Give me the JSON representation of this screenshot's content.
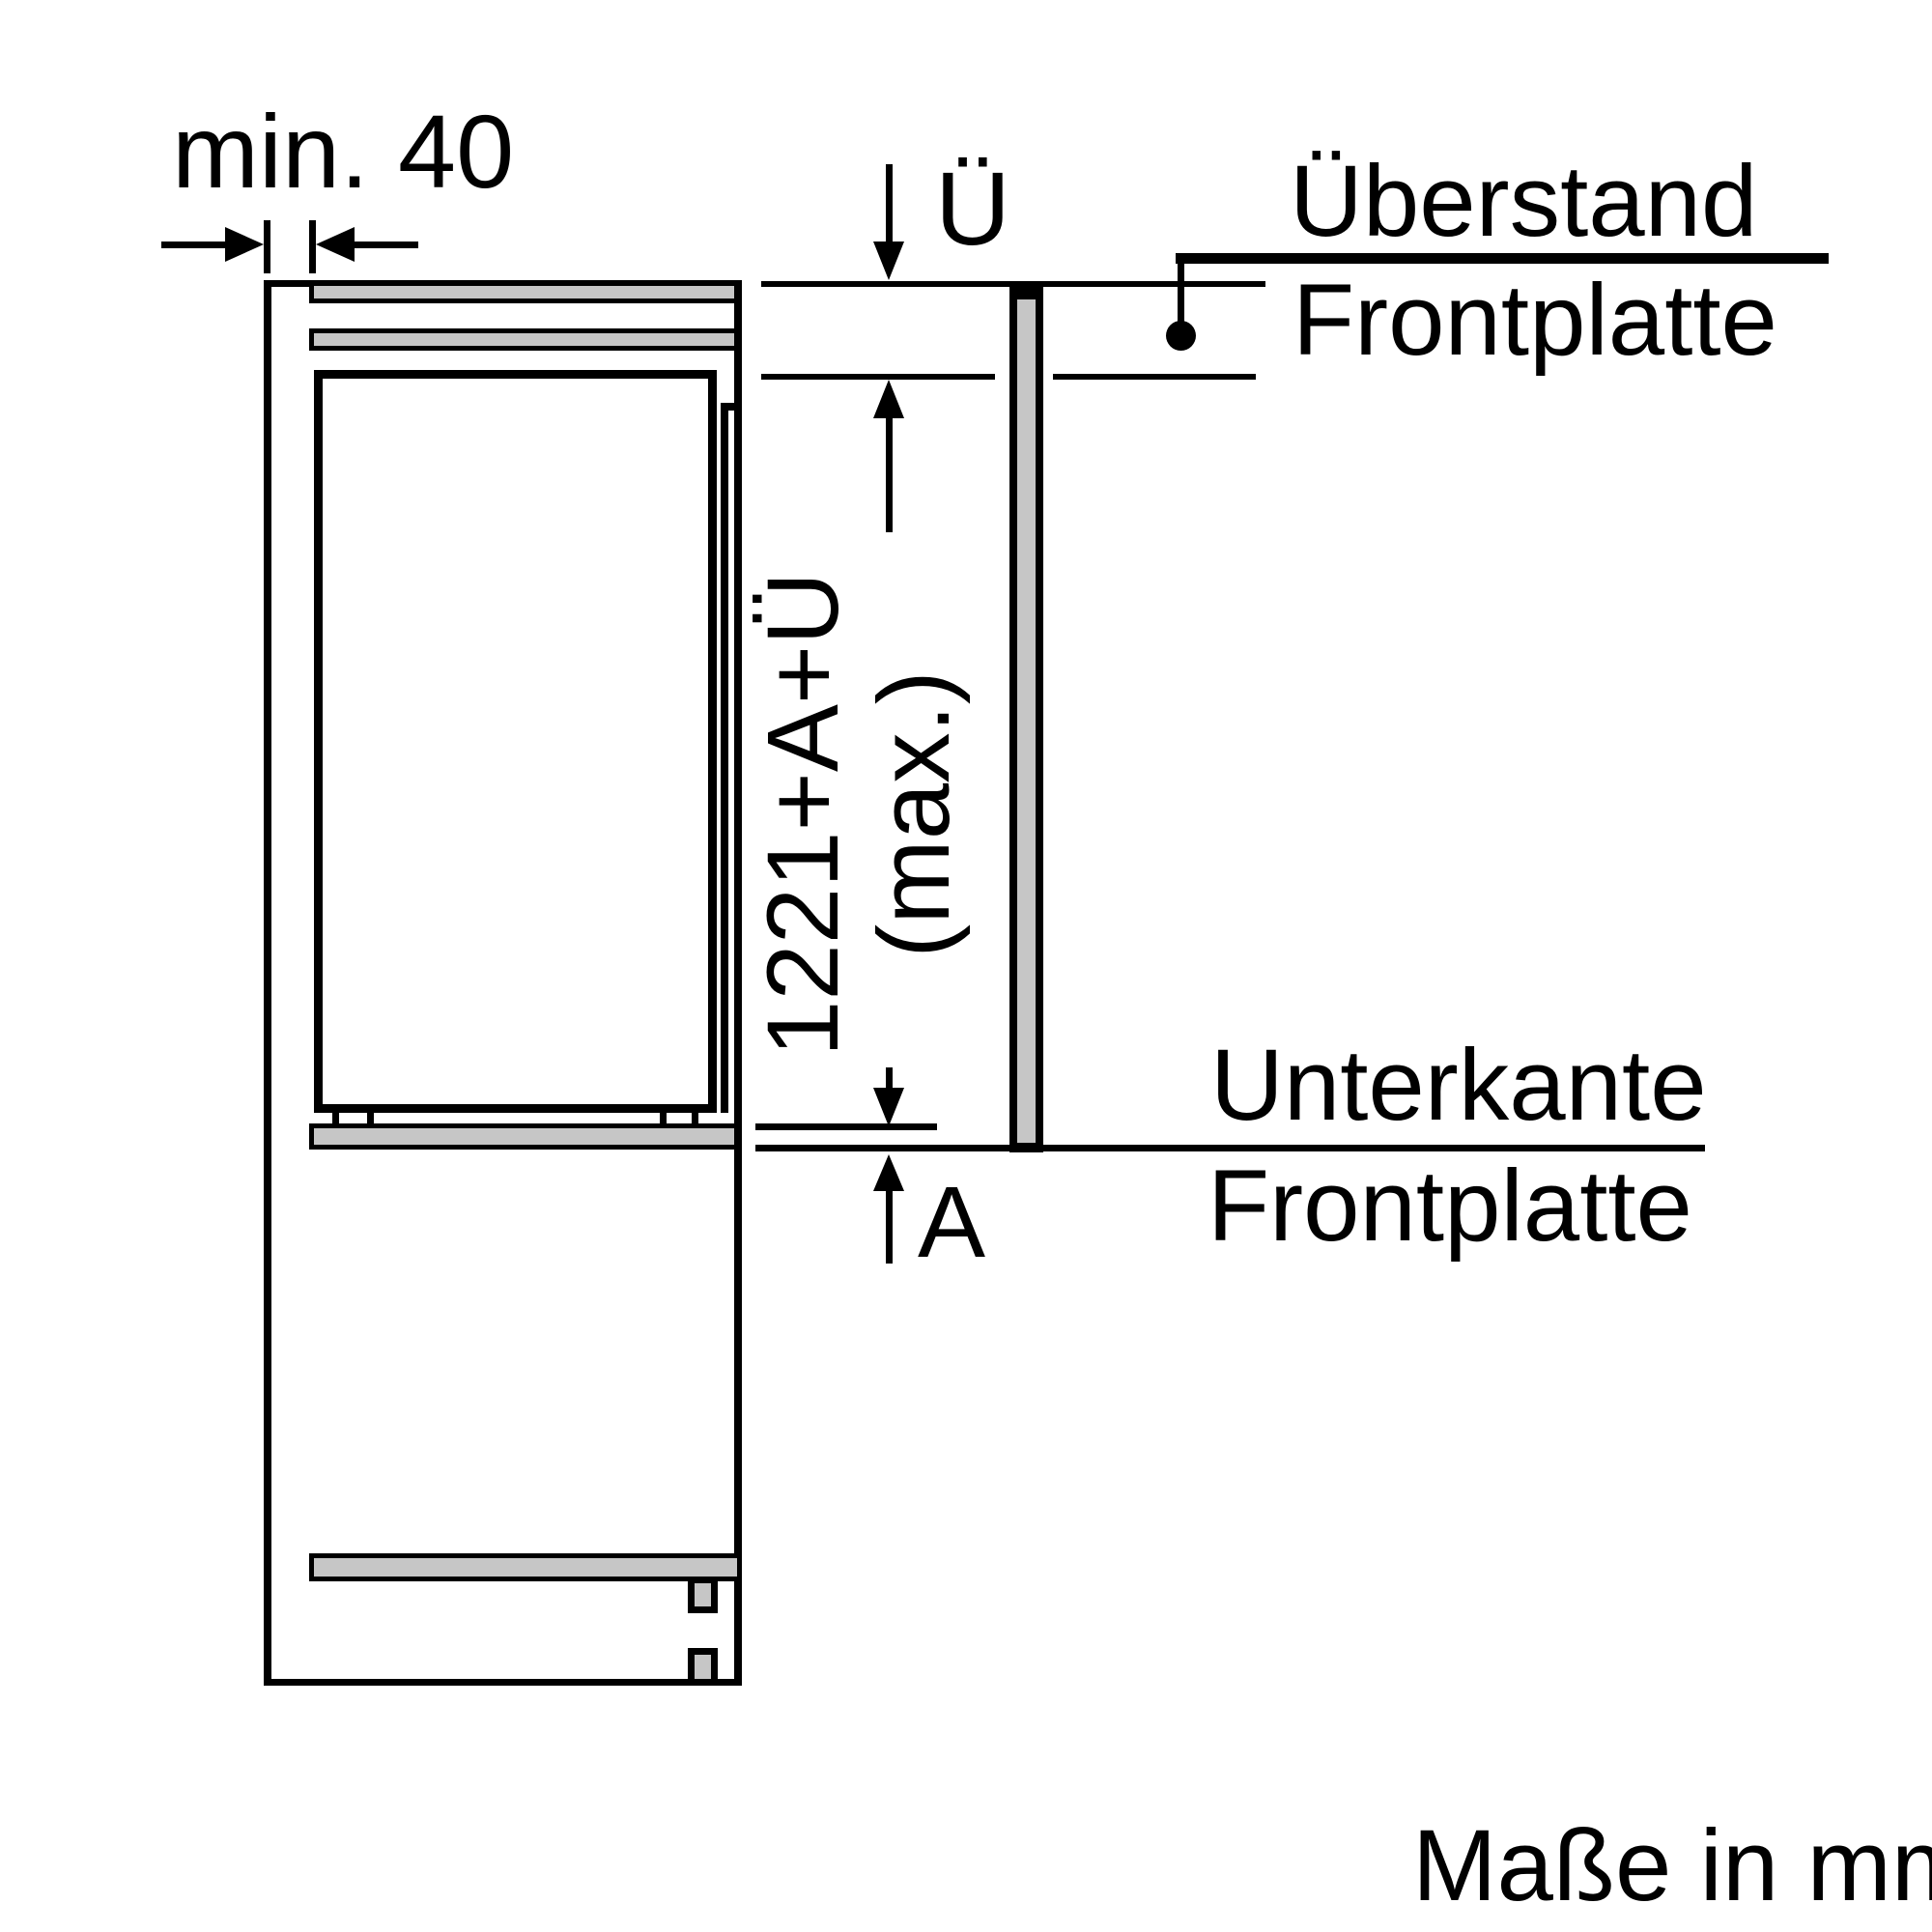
{
  "diagram": {
    "dim_min_gap": "min. 40",
    "dim_overhang_symbol": "Ü",
    "dim_panel_height_line1": "1221+A+Ü",
    "dim_panel_height_line2": "(max.)",
    "dim_bottom_gap_symbol": "A",
    "label_overhang_line1": "Überstand",
    "label_overhang_line2": "Frontplatte",
    "label_bottom_edge_line1": "Unterkante",
    "label_bottom_edge_line2": "Frontplatte",
    "note_units": "Maße in mm"
  },
  "colors": {
    "line": "#000000",
    "panel_fill": "#c6c6c6",
    "background": "#ffffff"
  }
}
